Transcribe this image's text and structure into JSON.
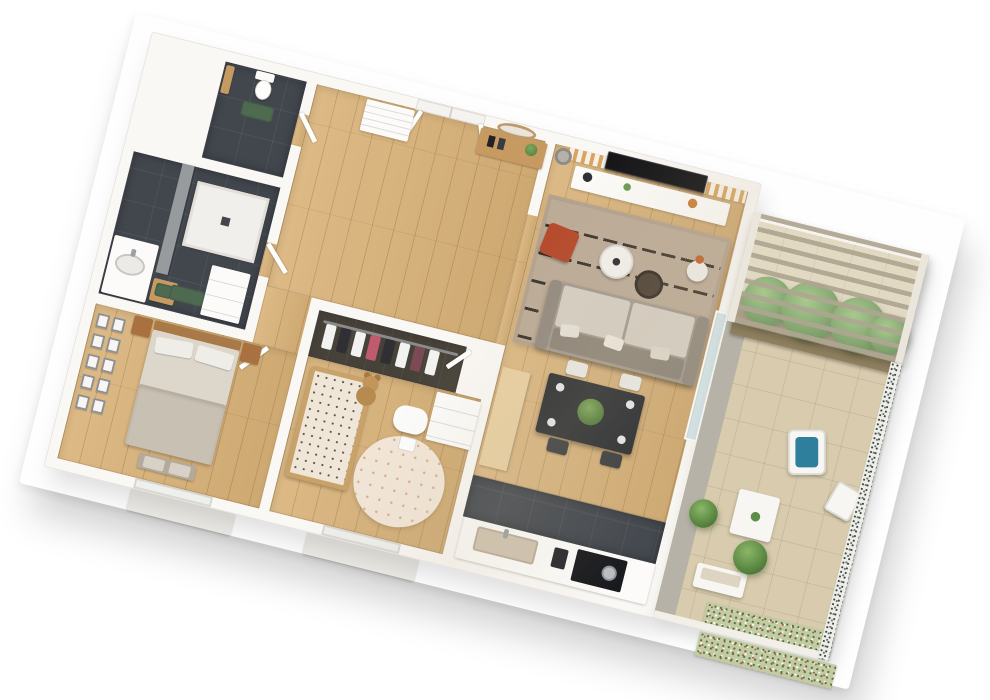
{
  "scene": {
    "type": "3d-floor-plan-render",
    "description": "Top-down 3D render of a two-bedroom apartment with wraparound terrace",
    "background_color": "#ffffff"
  },
  "palette": {
    "wall_white": "#faf8f5",
    "floor_wood": "#d9b278",
    "floor_dark_tile": "#42474e",
    "floor_terrace_tile": "#d9ccae",
    "mat_green": "#4e6b51",
    "sofa_gray": "#a39b8f",
    "rug_beige": "#bcab97",
    "pouf_rust": "#b5492a",
    "slat_panel_wood": "#d9a45f",
    "tv_black": "#121215",
    "dining_table_black": "#2a2d31",
    "bed_linen": "#ddd6cb",
    "crib_pattern": "#efe6d8",
    "plant_green": "#5d8c46",
    "cushion_blue": "#2d7f9b",
    "furniture_oak": "#c79a62"
  },
  "rooms": {
    "wc": {
      "label": "WC",
      "floor": "dark tile",
      "items": [
        "toilet",
        "green-mat",
        "roll-shelf"
      ]
    },
    "bathroom": {
      "label": "Bathroom",
      "floor": "dark tile",
      "items": [
        "walk-in-shower",
        "vanity-sink",
        "wood-stool",
        "green-towel",
        "laundry-unit",
        "green-mat",
        "tiled-feature-wall"
      ]
    },
    "bedroom": {
      "label": "Bedroom",
      "floor": "wood",
      "items": [
        "double-bed",
        "nightstand-left",
        "nightstand-right",
        "gallery-wall-frames",
        "foot-bench",
        "window"
      ]
    },
    "dressing": {
      "label": "Walk-in closet",
      "floor": "dark",
      "items": [
        "clothes-rail",
        "hanging-clothes"
      ]
    },
    "kids_room": {
      "label": "Kids room",
      "floor": "wood",
      "items": [
        "crib",
        "teddy-bear",
        "round-rug",
        "play-table",
        "play-chair",
        "dresser",
        "window"
      ]
    },
    "hall": {
      "label": "Entrance hall",
      "floor": "wood",
      "items": [
        "entry-double-door",
        "console-table",
        "oval-mirror",
        "books",
        "plant",
        "low-cabinet"
      ]
    },
    "living": {
      "label": "Living room",
      "floor": "wood",
      "items": [
        "slat-tv-wall",
        "tv",
        "media-console",
        "floor-lamp",
        "striped-rug",
        "sofa",
        "rust-pouf",
        "coffee-table",
        "woven-table",
        "side-table"
      ]
    },
    "dining": {
      "label": "Dining area",
      "floor": "wood",
      "items": [
        "black-dining-table",
        "four-chairs",
        "plant-centerpiece",
        "place-settings"
      ]
    },
    "kitchen": {
      "label": "Kitchen",
      "floor": "dark tile strip",
      "items": [
        "counter",
        "sink",
        "faucet",
        "coffee-machine",
        "cooktop",
        "pot",
        "tall-wood-cabinet"
      ]
    },
    "terrace": {
      "label": "Terrace",
      "floor": "beige tile",
      "items": [
        "pergola",
        "hedge-planter",
        "lounge-chair-blue-cushion",
        "slatted-table",
        "outdoor-chair",
        "bench",
        "potted-plants",
        "flower-bed",
        "speckled-railing",
        "glass-sliding-door"
      ]
    }
  }
}
